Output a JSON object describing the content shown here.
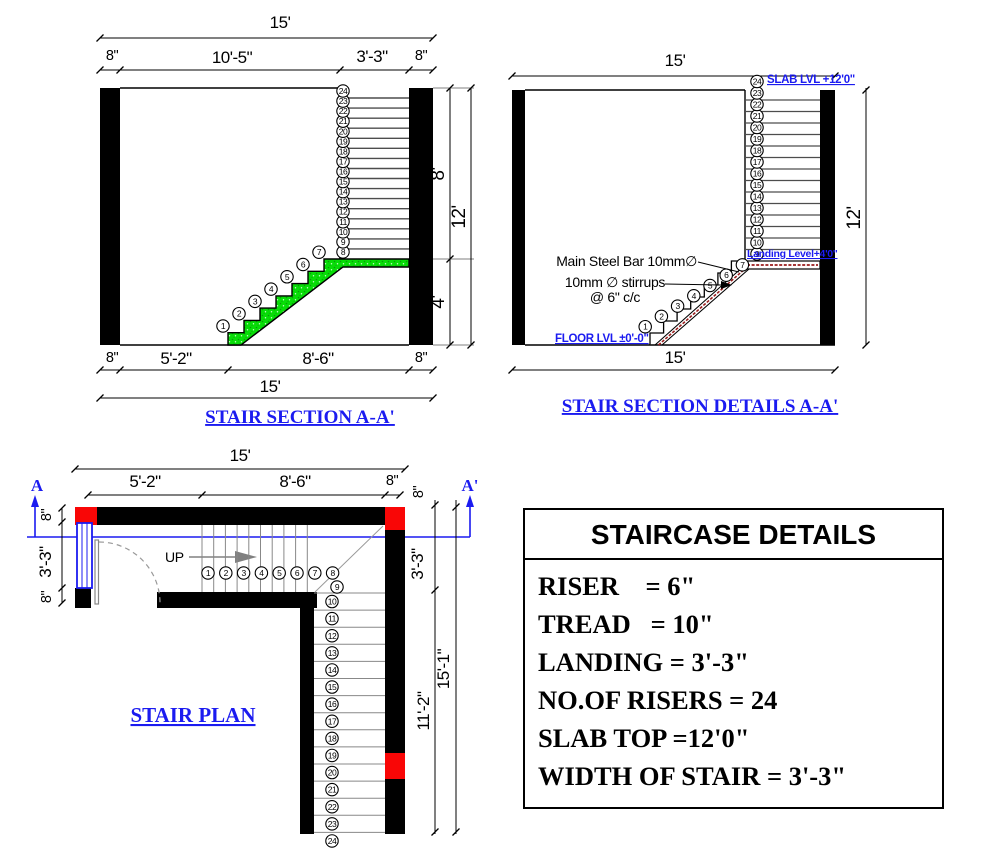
{
  "colors": {
    "blue_accent": "#1b1bf0",
    "flight_green": "#07dd07",
    "column_red": "#f90606",
    "steel_red": "#9b1c1c",
    "wall_black": "#000000"
  },
  "risers": {
    "count": 24,
    "numbers": [
      1,
      2,
      3,
      4,
      5,
      6,
      7,
      8,
      9,
      10,
      11,
      12,
      13,
      14,
      15,
      16,
      17,
      18,
      19,
      20,
      21,
      22,
      23,
      24
    ]
  },
  "section_a": {
    "title": "STAIR SECTION A-A'",
    "dims": {
      "top_total": "15'",
      "top_row": [
        "8\"",
        "10'-5\"",
        "3'-3\"",
        "8\""
      ],
      "bottom_row": [
        "8\"",
        "5'-2\"",
        "8'-6\"",
        "8\""
      ],
      "bottom_total": "15'",
      "right_upper": "8'",
      "right_lower": "4'",
      "right_total": "12'"
    }
  },
  "section_details": {
    "title": "STAIR SECTION DETAILS A-A'",
    "dims": {
      "top_total": "15'",
      "bottom_total": "15'",
      "right_total": "12'"
    },
    "labels": {
      "slab_level": "SLAB LVL +12'0\"",
      "landing_level": "Landing Level+4'0\"",
      "floor_level": "FLOOR LVL ±0'-0\"",
      "main_steel": "Main Steel Bar 10mm∅",
      "stirrups_line1": "10mm ∅ stirrups",
      "stirrups_line2": "@ 6\" c/c"
    }
  },
  "plan": {
    "title": "STAIR PLAN",
    "up_label": "UP",
    "section_marker_start": "A",
    "section_marker_end": "A'",
    "dims": {
      "top_total": "15'",
      "top_row": [
        "5'-2\"",
        "8'-6\"",
        "8\""
      ],
      "left_col": [
        "8\"",
        "3'-3\"",
        "8\""
      ],
      "right_col": [
        "8\"",
        "3'-3\"",
        "11'-2\"",
        "15'-1\""
      ]
    }
  },
  "details_table": {
    "title": "STAIRCASE DETAILS",
    "rows": [
      "RISER    = 6\"",
      "TREAD   = 10\"",
      "LANDING = 3'-3\"",
      "NO.OF RISERS = 24",
      "SLAB TOP =12'0\"",
      "WIDTH OF STAIR = 3'-3\""
    ]
  }
}
